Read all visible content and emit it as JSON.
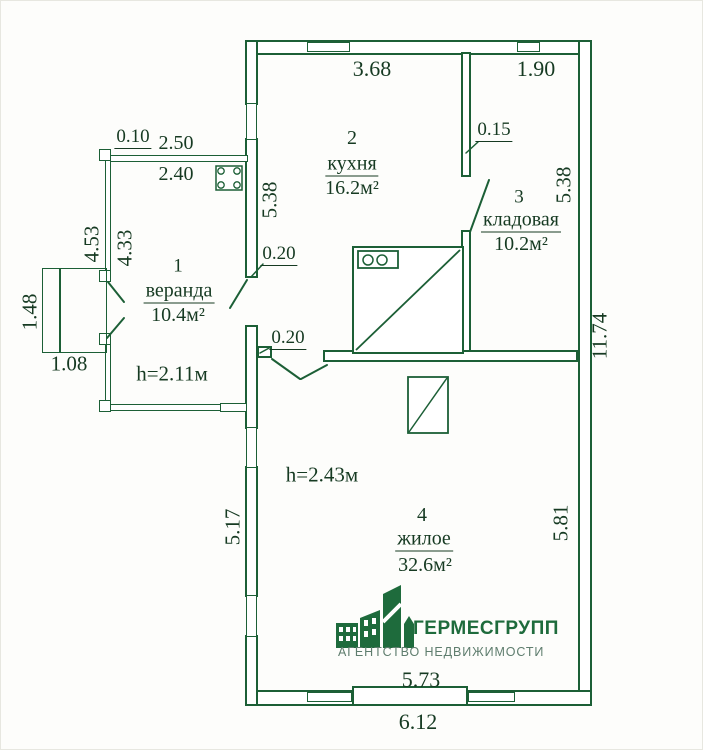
{
  "colors": {
    "line": "#1c5f36",
    "text": "#163a22",
    "logo_green": "#1e6b3c",
    "logo_tagline": "#5f7d6e",
    "background": "#fdfdfb"
  },
  "rooms": [
    {
      "number": "1",
      "name": "веранда",
      "area": "10.4м²",
      "height_note": "h=2.11м"
    },
    {
      "number": "2",
      "name": "кухня",
      "area": "16.2м²",
      "height_note": ""
    },
    {
      "number": "3",
      "name": "кладовая",
      "area": "10.2м²",
      "height_note": ""
    },
    {
      "number": "4",
      "name": "жилое",
      "area": "32.6м²",
      "height_note": "h=2.43м"
    }
  ],
  "dimensions": {
    "top_kitchen": "3.68",
    "top_storage": "1.90",
    "storage_wall_thickness": "0.15",
    "kitchen_left_height": "5.38",
    "storage_right_height": "5.38",
    "door_wall_upper": "0.20",
    "door_wall_lower": "0.20",
    "veranda_wall_thickness": "0.10",
    "veranda_top_outer": "2.50",
    "veranda_top_inner": "2.40",
    "veranda_left_outer": "4.53",
    "veranda_left_inner": "4.33",
    "porch_depth": "1.48",
    "porch_width": "1.08",
    "right_total": "11.74",
    "living_right_height": "5.81",
    "living_left_height": "5.17",
    "bottom_inner": "5.73",
    "bottom_outer": "6.12"
  },
  "logo": {
    "name": "ГЕРМЕСГРУПП",
    "tagline": "АГЕНТСТВО НЕДВИЖИМОСТИ"
  }
}
